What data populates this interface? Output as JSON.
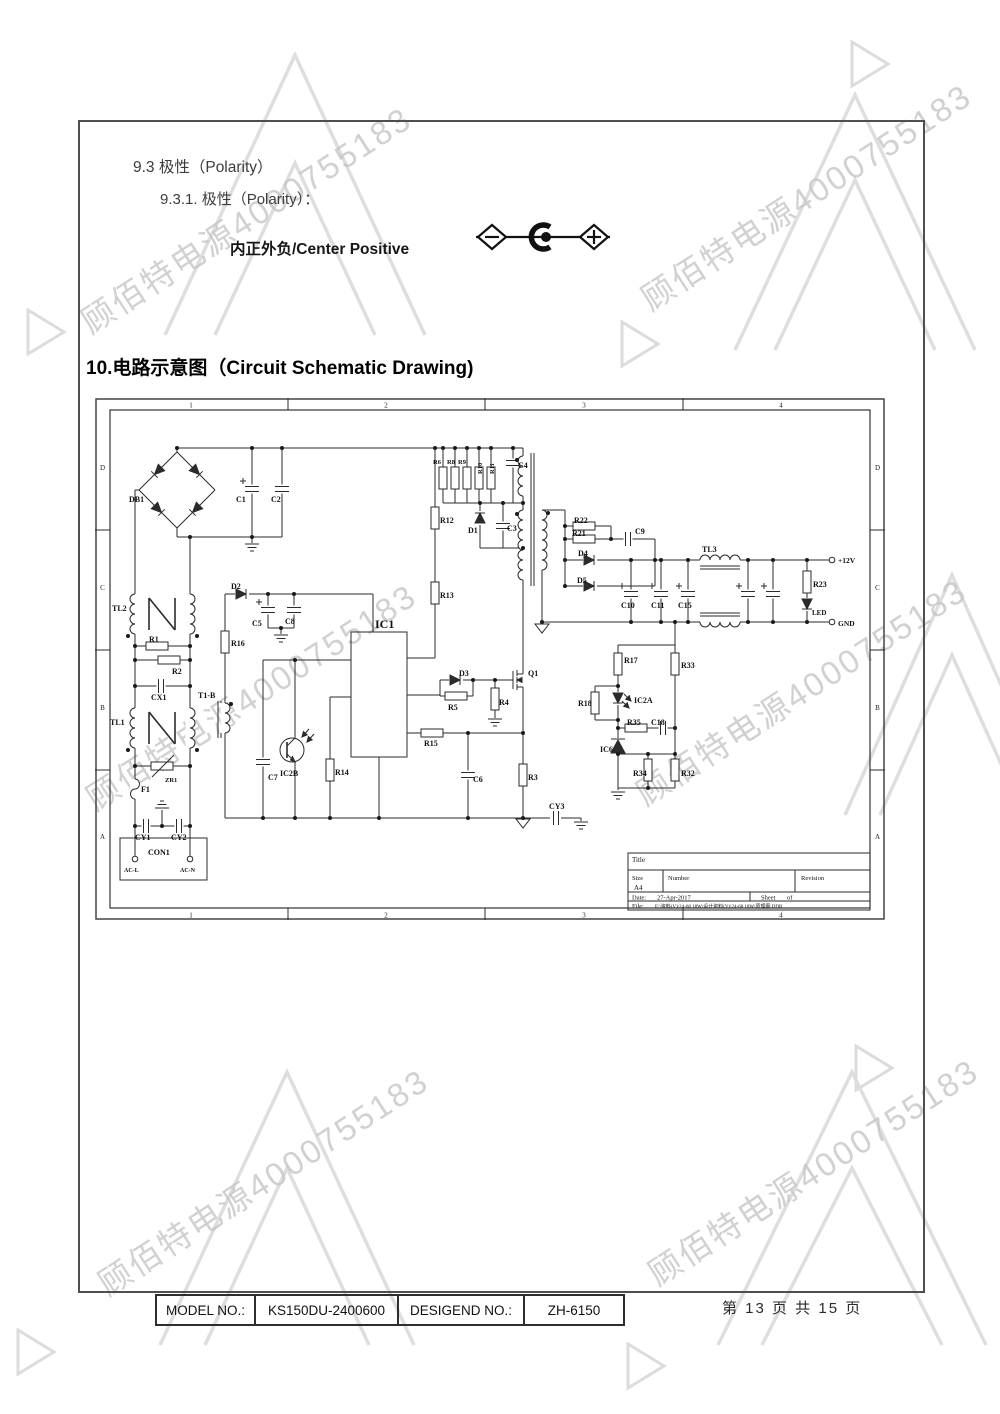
{
  "document": {
    "section_9_3": "9.3 极性（Polarity）",
    "section_9_3_1": "9.3.1.  极性（Polarity）：",
    "polarity_text": "内正外负/Center Positive",
    "section_10_title": "10.电路示意图（Circuit Schematic Drawing)"
  },
  "watermark": {
    "text": "顾佰特电源4000755183",
    "color": "#c6c6c6"
  },
  "footer": {
    "model_label": "MODEL NO.:",
    "model_value": "KS150DU-2400600",
    "design_label": "DESIGEND NO.:",
    "design_value": "ZH-6150",
    "page_info": "第 13 页 共 15 页"
  },
  "schematic": {
    "border": {
      "cols": [
        "1",
        "2",
        "3",
        "4"
      ],
      "rows": [
        "D",
        "C",
        "B",
        "A"
      ]
    },
    "title_block": {
      "title_label": "Title",
      "size_label": "Size",
      "size_value": "A4",
      "number_label": "Number",
      "revision_label": "Revision",
      "date_label": "Date:",
      "date_value": "27-Apr-2017",
      "sheet_label": "Sheet",
      "of_label": "of",
      "file_label": "File:",
      "file_value": "E:\\资料(V)\\24-68 18W\\设计资料(V)\\24-68 18W\\原理图.DDB"
    },
    "labels": [
      {
        "t": "DB1",
        "x": 34,
        "y": 104
      },
      {
        "t": "C1",
        "x": 141,
        "y": 104
      },
      {
        "t": "C2",
        "x": 176,
        "y": 104
      },
      {
        "t": "TL2",
        "x": 17,
        "y": 213
      },
      {
        "t": "R1",
        "x": 54,
        "y": 244
      },
      {
        "t": "R2",
        "x": 77,
        "y": 276
      },
      {
        "t": "CX1",
        "x": 56,
        "y": 302
      },
      {
        "t": "TL1",
        "x": 15,
        "y": 327
      },
      {
        "t": "ZR1",
        "x": 70,
        "y": 384,
        "s": 6.5
      },
      {
        "t": "F1",
        "x": 46,
        "y": 394
      },
      {
        "t": "CY1",
        "x": 40,
        "y": 442
      },
      {
        "t": "CY2",
        "x": 76,
        "y": 442
      },
      {
        "t": "CON1",
        "x": 53,
        "y": 457
      },
      {
        "t": "AC-L",
        "x": 29,
        "y": 474,
        "s": 6
      },
      {
        "t": "AC-N",
        "x": 85,
        "y": 474,
        "s": 6
      },
      {
        "t": "T1-B",
        "x": 103,
        "y": 300
      },
      {
        "t": "R16",
        "x": 136,
        "y": 248
      },
      {
        "t": "D2",
        "x": 136,
        "y": 191
      },
      {
        "t": "C5",
        "x": 157,
        "y": 228
      },
      {
        "t": "C8",
        "x": 190,
        "y": 226
      },
      {
        "t": "C7",
        "x": 173,
        "y": 382
      },
      {
        "t": "IC2B",
        "x": 185,
        "y": 378
      },
      {
        "t": "R14",
        "x": 240,
        "y": 377
      },
      {
        "t": "IC1",
        "x": 280,
        "y": 230,
        "s": 12,
        "w": "normal"
      },
      {
        "t": "R12",
        "x": 345,
        "y": 125
      },
      {
        "t": "R13",
        "x": 345,
        "y": 200
      },
      {
        "t": "R6",
        "x": 338,
        "y": 66,
        "s": 6.5
      },
      {
        "t": "R8",
        "x": 352,
        "y": 66,
        "s": 6.5
      },
      {
        "t": "R9",
        "x": 363,
        "y": 66,
        "s": 6.5
      },
      {
        "t": "R10",
        "x": 387,
        "y": 76,
        "s": 6.5,
        "r": -90
      },
      {
        "t": "R11",
        "x": 399,
        "y": 76,
        "s": 6.5,
        "r": -90
      },
      {
        "t": "C4",
        "x": 423,
        "y": 70
      },
      {
        "t": "D1",
        "x": 373,
        "y": 135
      },
      {
        "t": "C3",
        "x": 412,
        "y": 133
      },
      {
        "t": "D3",
        "x": 364,
        "y": 278
      },
      {
        "t": "R5",
        "x": 353,
        "y": 312
      },
      {
        "t": "R4",
        "x": 404,
        "y": 307
      },
      {
        "t": "Q1",
        "x": 433,
        "y": 278
      },
      {
        "t": "R15",
        "x": 329,
        "y": 348
      },
      {
        "t": "C6",
        "x": 378,
        "y": 384
      },
      {
        "t": "R3",
        "x": 433,
        "y": 382
      },
      {
        "t": "CY3",
        "x": 454,
        "y": 411
      },
      {
        "t": "R22",
        "x": 479,
        "y": 125
      },
      {
        "t": "R21",
        "x": 477,
        "y": 138
      },
      {
        "t": "C9",
        "x": 540,
        "y": 136
      },
      {
        "t": "D4",
        "x": 483,
        "y": 158
      },
      {
        "t": "D5",
        "x": 482,
        "y": 185
      },
      {
        "t": "C10",
        "x": 526,
        "y": 210
      },
      {
        "t": "C11",
        "x": 556,
        "y": 210
      },
      {
        "t": "C15",
        "x": 583,
        "y": 210
      },
      {
        "t": "TL3",
        "x": 607,
        "y": 154
      },
      {
        "t": "+12V",
        "x": 743,
        "y": 165,
        "s": 7.5
      },
      {
        "t": "R23",
        "x": 718,
        "y": 189
      },
      {
        "t": "LED",
        "x": 717,
        "y": 217,
        "s": 7
      },
      {
        "t": "GND",
        "x": 743,
        "y": 228,
        "s": 7.5
      },
      {
        "t": "R17",
        "x": 529,
        "y": 265
      },
      {
        "t": "R33",
        "x": 586,
        "y": 270
      },
      {
        "t": "R18",
        "x": 483,
        "y": 308
      },
      {
        "t": "IC2A",
        "x": 539,
        "y": 305
      },
      {
        "t": "R35",
        "x": 532,
        "y": 327
      },
      {
        "t": "C18",
        "x": 556,
        "y": 327
      },
      {
        "t": "IC6",
        "x": 505,
        "y": 354
      },
      {
        "t": "R34",
        "x": 538,
        "y": 378
      },
      {
        "t": "R32",
        "x": 586,
        "y": 378
      }
    ]
  }
}
